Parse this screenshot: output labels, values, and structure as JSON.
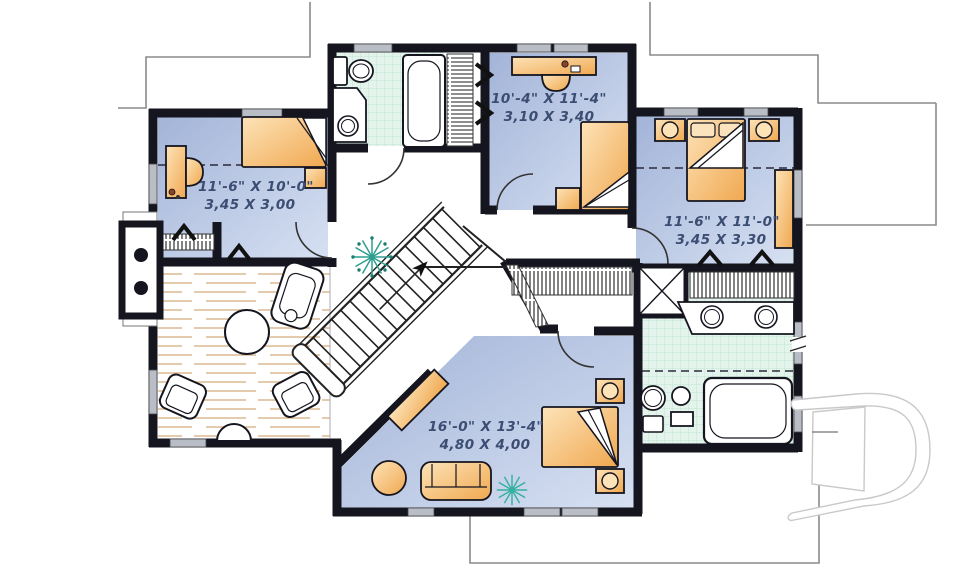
{
  "plan": {
    "type": "second-floor-plan",
    "rooms": {
      "bedroom_top": {
        "imperial": "10'-4\" X 11'-4\"",
        "metric": "3,10 X 3,40"
      },
      "bedroom_left": {
        "imperial": "11'-6\" X 10'-0\"",
        "metric": "3,45 X 3,00"
      },
      "bedroom_right": {
        "imperial": "11'-6\" X 11'-0\"",
        "metric": "3,45 X 3,30"
      },
      "bedroom_master": {
        "imperial": "16'-0\" X 13'-4\"",
        "metric": "4,80 X 4,00"
      }
    },
    "icons": {
      "logo": "stylized-D-builder-logo",
      "plants": "starburst-plant-icon",
      "stairs": "diagonal-staircase-with-direction-arrow"
    },
    "colors": {
      "wall": "#15151f",
      "floor_blue_dark": "#a9b9da",
      "floor_blue_light": "#d6e0f2",
      "tile_green": "#e4f4ec",
      "tile_grid": "#bfe3d3",
      "furniture_light": "#fde3b8",
      "furniture_dark": "#f0a850",
      "wood_line": "#dcba92",
      "window": "#b9bec6",
      "plant": "#2e9e8f",
      "dimension_text": "#3b4d72",
      "roof_outline": "#8a8a8a",
      "logo_gray": "#c9c9c9"
    }
  }
}
